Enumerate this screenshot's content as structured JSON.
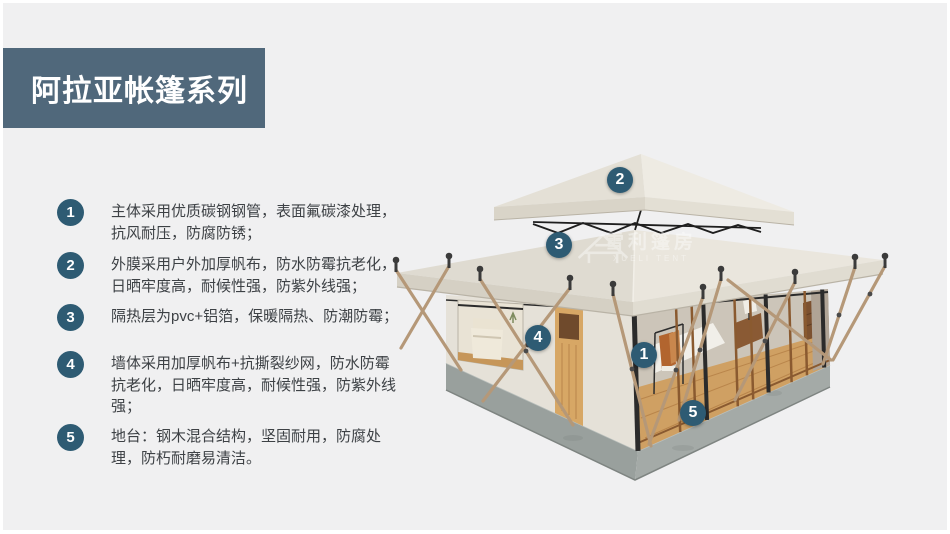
{
  "title": {
    "text": "阿拉亚帐篷系列"
  },
  "features": [
    {
      "num": "1",
      "text": "主体采用优质碳钢钢管，表面氟碳漆处理，抗风耐压，防腐防锈；"
    },
    {
      "num": "2",
      "text": "外膜采用户外加厚帆布，防水防霉抗老化，日晒牢度高，耐候性强，防紫外线强；"
    },
    {
      "num": "3",
      "text": "隔热层为pvc+铝箔，保暖隔热、防潮防霉；"
    },
    {
      "num": "4",
      "text": "墙体采用加厚帆布+抗撕裂纱网，防水防霉抗老化，日晒牢度高，耐候性强，防紫外线强；"
    },
    {
      "num": "5",
      "text": "地台：钢木混合结构，坚固耐用，防腐处理，防朽耐磨易清洁。"
    }
  ],
  "tent_markers": {
    "m1": "1",
    "m2": "2",
    "m3": "3",
    "m4": "4",
    "m5": "5"
  },
  "watermark": {
    "cn": "雪利篷房",
    "en": "XUELI TENT"
  },
  "colors": {
    "accent": "#2e5b73",
    "title_box": "#50687b",
    "background": "#f0f0f1",
    "tent_canvas": "#e8e4db",
    "base_gray": "#9aa19e",
    "wood_floor": "#cf9d5e"
  }
}
